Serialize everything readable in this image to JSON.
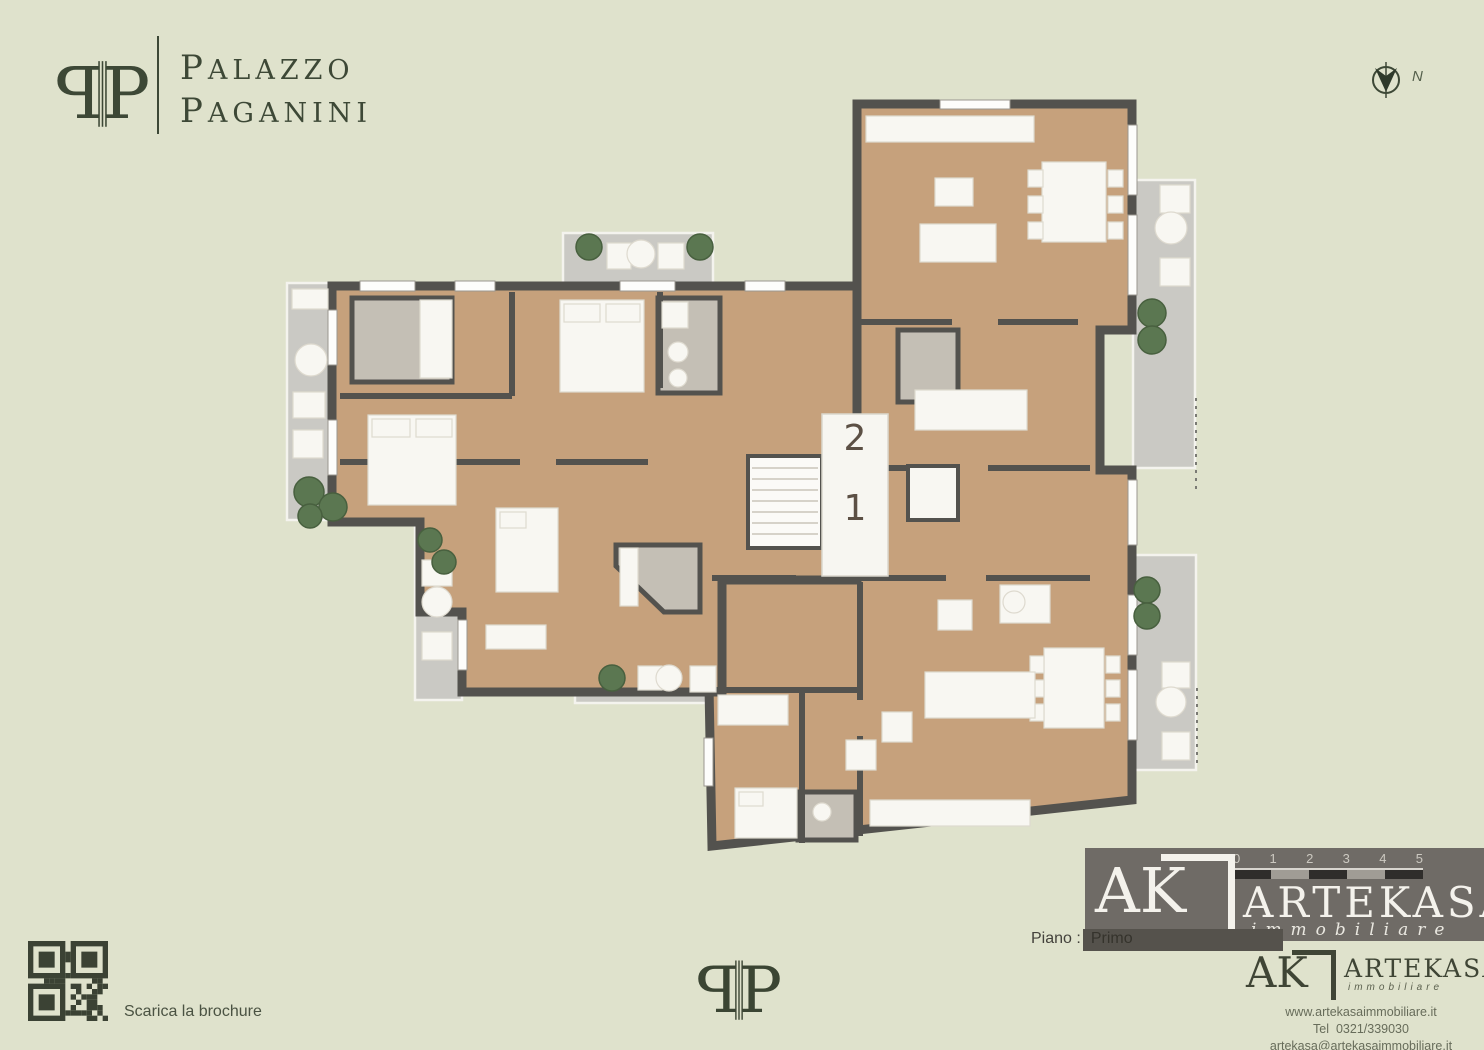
{
  "brand": {
    "monogram": "PP",
    "line1": "Palazzo",
    "line2": "Paganini",
    "color": "#3d4836"
  },
  "compass": {
    "label": "N"
  },
  "plan": {
    "floor_label": {
      "prefix": "Piano :",
      "value": "Primo"
    },
    "units": [
      {
        "number": "2"
      },
      {
        "number": "1"
      }
    ],
    "colors": {
      "wood": "#c6a17c",
      "wall": "#53524e",
      "terrace": "#cac9c4",
      "bath": "#c4bfb5",
      "plant": "#5b7751",
      "furniture": "#f8f7f2"
    }
  },
  "scale_bar": {
    "ticks": [
      "0",
      "1",
      "2",
      "3",
      "4",
      "5"
    ]
  },
  "watermark": {
    "ak": "AK",
    "name": "ARTEKASA",
    "subtitle": "immobiliare"
  },
  "agency": {
    "ak": "AK",
    "name": "ARTEKASA",
    "subtitle": "immobiliare",
    "website": "www.artekasaimmobiliare.it",
    "tel_label": "Tel",
    "tel": "0321/339030",
    "email": "artekasa@artekasaimmobiliare.it"
  },
  "footer": {
    "qr_label": "Scarica la brochure"
  },
  "page": {
    "background": "#dfe2cc",
    "watermark_bg": "#6f6b66"
  }
}
